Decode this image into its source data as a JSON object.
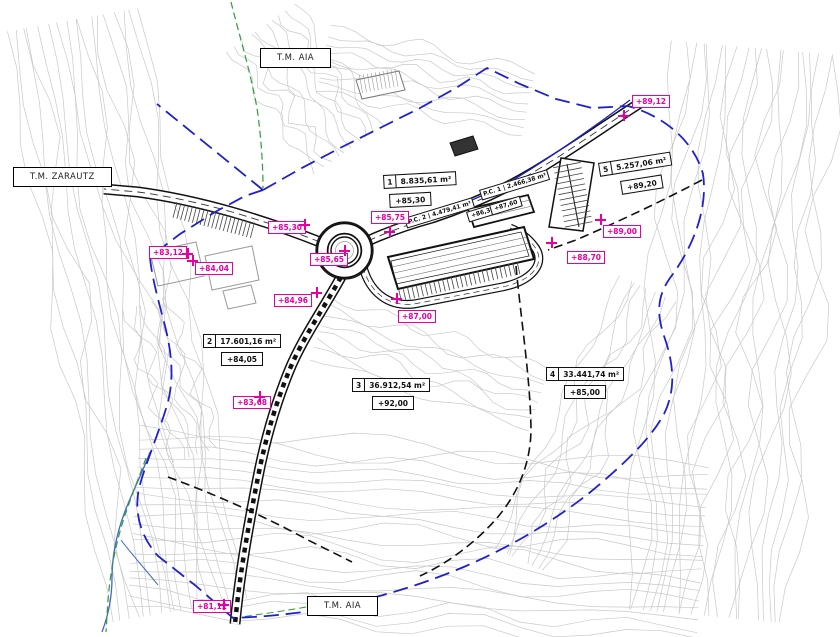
{
  "map": {
    "municipalities": {
      "top": "T.M. AIA",
      "left": "T.M. ZARAUTZ",
      "bottom": "T.M. AIA"
    },
    "elevation_points": [
      {
        "label": "+89,12"
      },
      {
        "label": "+83,12"
      },
      {
        "label": "+84,04"
      },
      {
        "label": "+85,30"
      },
      {
        "label": "+85,65"
      },
      {
        "label": "+85,75"
      },
      {
        "label": "+84,96"
      },
      {
        "label": "+87,00"
      },
      {
        "label": "+88,70"
      },
      {
        "label": "+89,00"
      },
      {
        "label": "+83,68"
      },
      {
        "label": "+81,12"
      }
    ],
    "parcels": [
      {
        "number": "1",
        "area": "8.835,61 m²",
        "elevation": "+85,30"
      },
      {
        "number": "2",
        "area": "17.601,16 m²",
        "elevation": "+84,05"
      },
      {
        "number": "3",
        "area": "36.912,54 m²",
        "elevation": "+92,00"
      },
      {
        "number": "4",
        "area": "33.441,74 m²",
        "elevation": "+85,00"
      },
      {
        "number": "5",
        "area": "5.257,06 m²",
        "elevation": "+89,20"
      }
    ],
    "plot_labels": [
      {
        "label": "P.C. 2 | 4.479,41 m²",
        "elevation": "+86,30"
      },
      {
        "label": "P.C. 1 | 2.466,38 m²",
        "elevation": "+87,60"
      }
    ],
    "colors": {
      "boundary_blue": "#2020cc",
      "elevation_magenta": "#e500a4",
      "contour_gray": "#c9c9c9",
      "road_black": "#1a1a1a",
      "stream_blue": "#4466cc",
      "vegetation_green": "#2e9e3a"
    }
  }
}
